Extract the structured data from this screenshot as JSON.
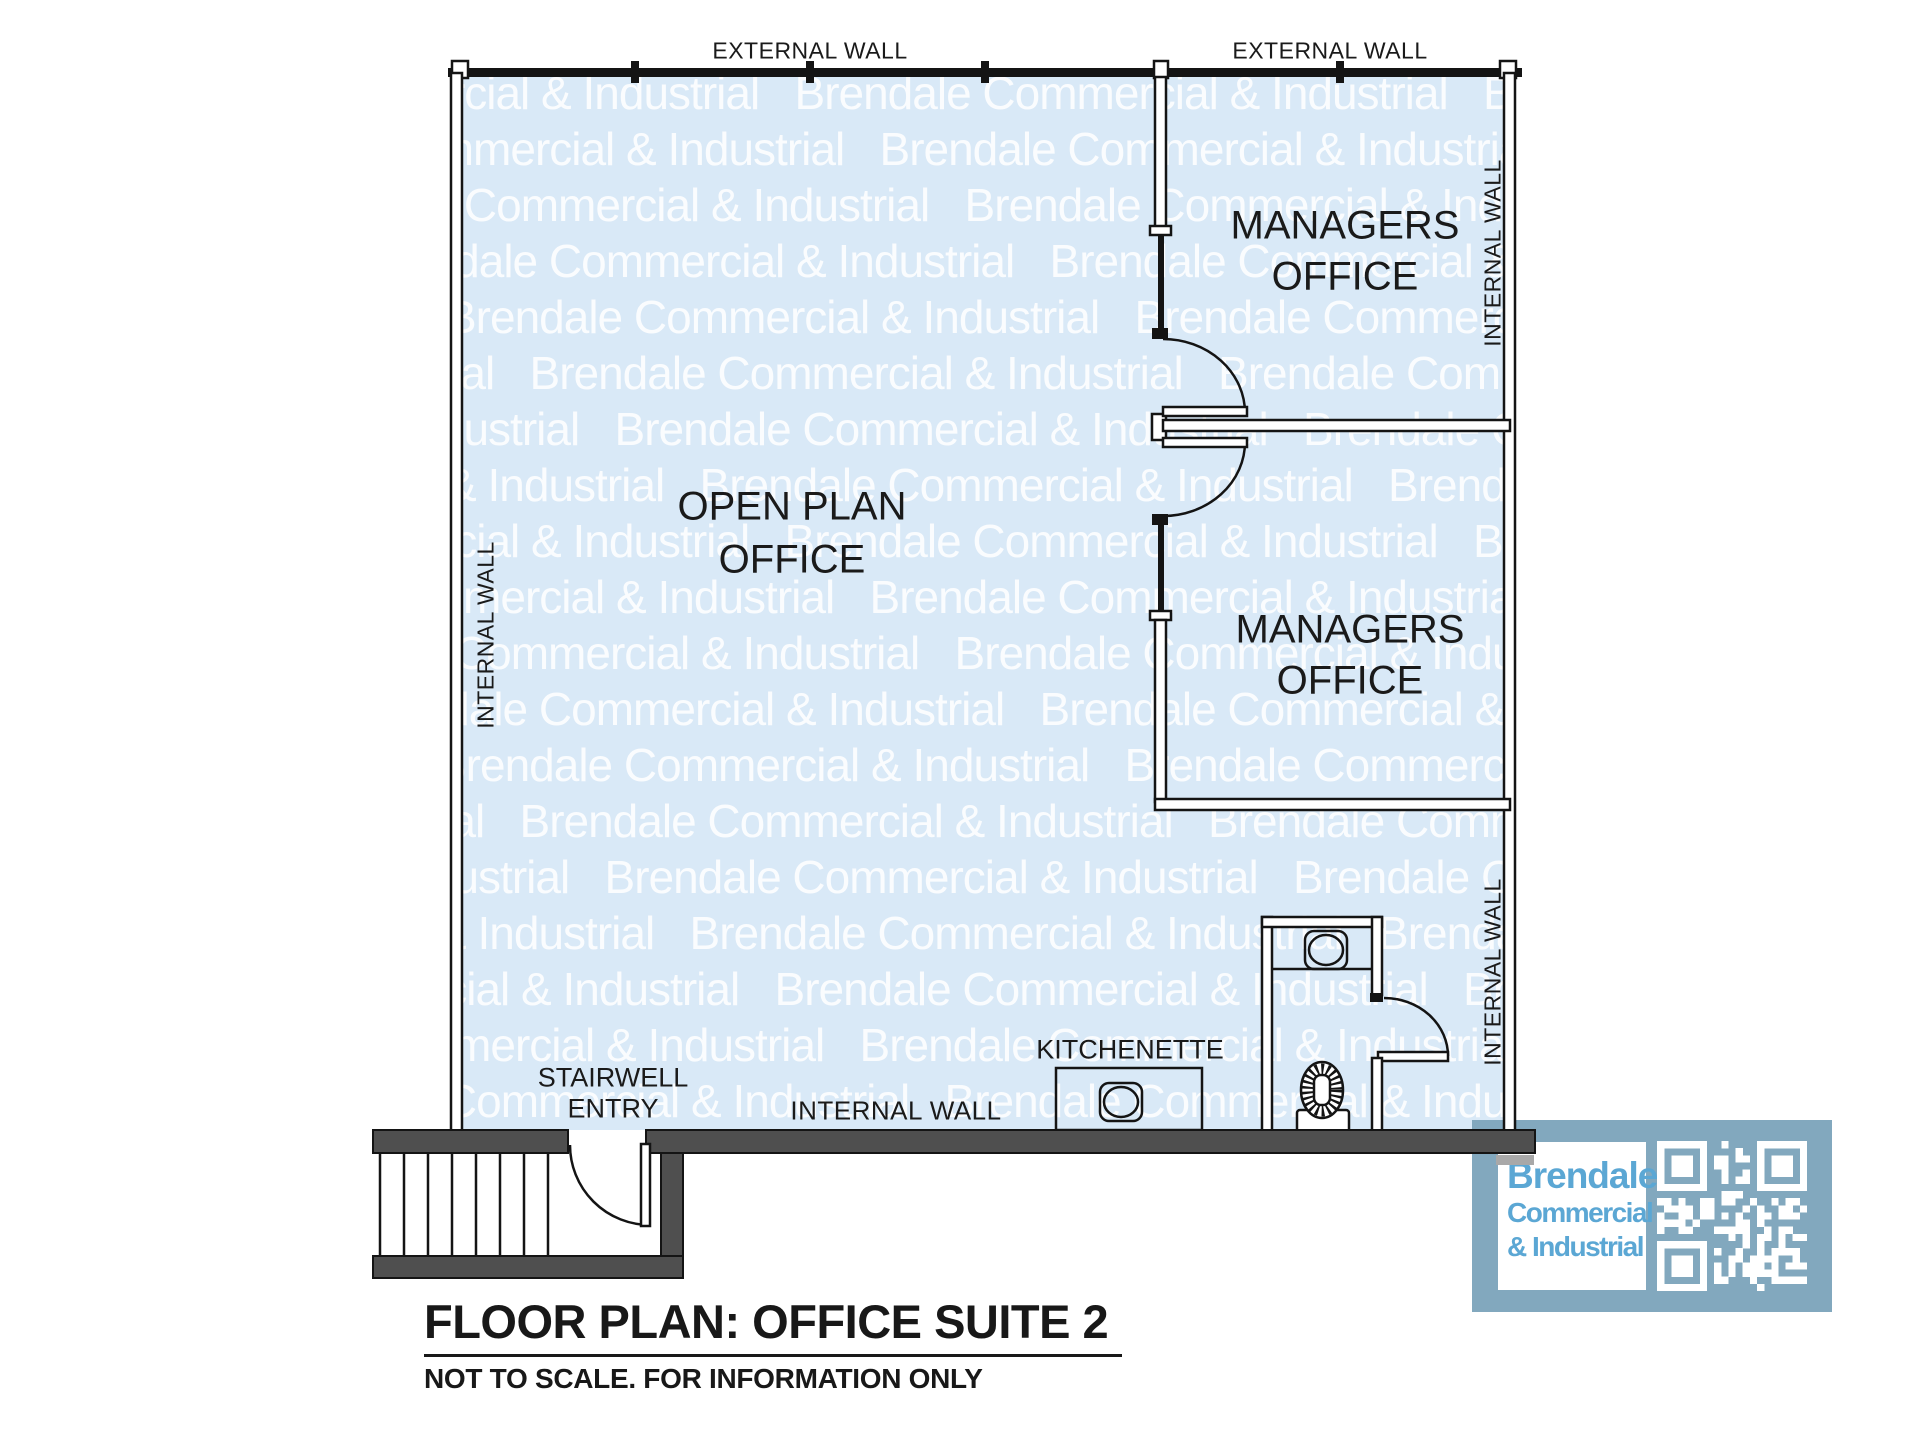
{
  "title": {
    "text": "FLOOR PLAN: OFFICE SUITE 2",
    "subtitle": "NOT TO SCALE. FOR INFORMATION ONLY"
  },
  "wall_labels": {
    "external_top_left": "EXTERNAL WALL",
    "external_top_right": "EXTERNAL WALL",
    "internal_left": "INTERNAL WALL",
    "internal_right_top": "INTERNAL WALL",
    "internal_right_bottom": "INTERNAL WALL",
    "internal_bottom": "INTERNAL WALL"
  },
  "rooms": {
    "open_plan": {
      "line1": "OPEN PLAN",
      "line2": "OFFICE"
    },
    "managers_1": {
      "line1": "MANAGERS",
      "line2": "OFFICE"
    },
    "managers_2": {
      "line1": "MANAGERS",
      "line2": "OFFICE"
    },
    "kitchenette": {
      "label": "KITCHENETTE"
    },
    "stairwell": {
      "line1": "STAIRWELL",
      "line2": "ENTRY"
    }
  },
  "fixtures": {
    "kitchen_sink": "sink-icon",
    "bathroom_sink": "sink-icon",
    "toilet": "toilet-icon",
    "doors": [
      "door-managers-office-1",
      "door-managers-office-2",
      "door-bathroom",
      "door-stairwell"
    ]
  },
  "watermark": {
    "text": "Brendale Commercial & Industrial",
    "color": "rgba(255,255,255,0.85)"
  },
  "logo": {
    "line1": "Brendale",
    "line2": "Commercial",
    "line3": "& Industrial",
    "qr": "qr-code-icon",
    "bg_color": "#82a8be",
    "text_color": "#5ba7d4"
  },
  "colors": {
    "floor": "#d9e9f7",
    "line": "#141414",
    "dark_wall": "#4f4f4f",
    "logo_bg": "#82a8be",
    "logo_text": "#5ba7d4"
  }
}
